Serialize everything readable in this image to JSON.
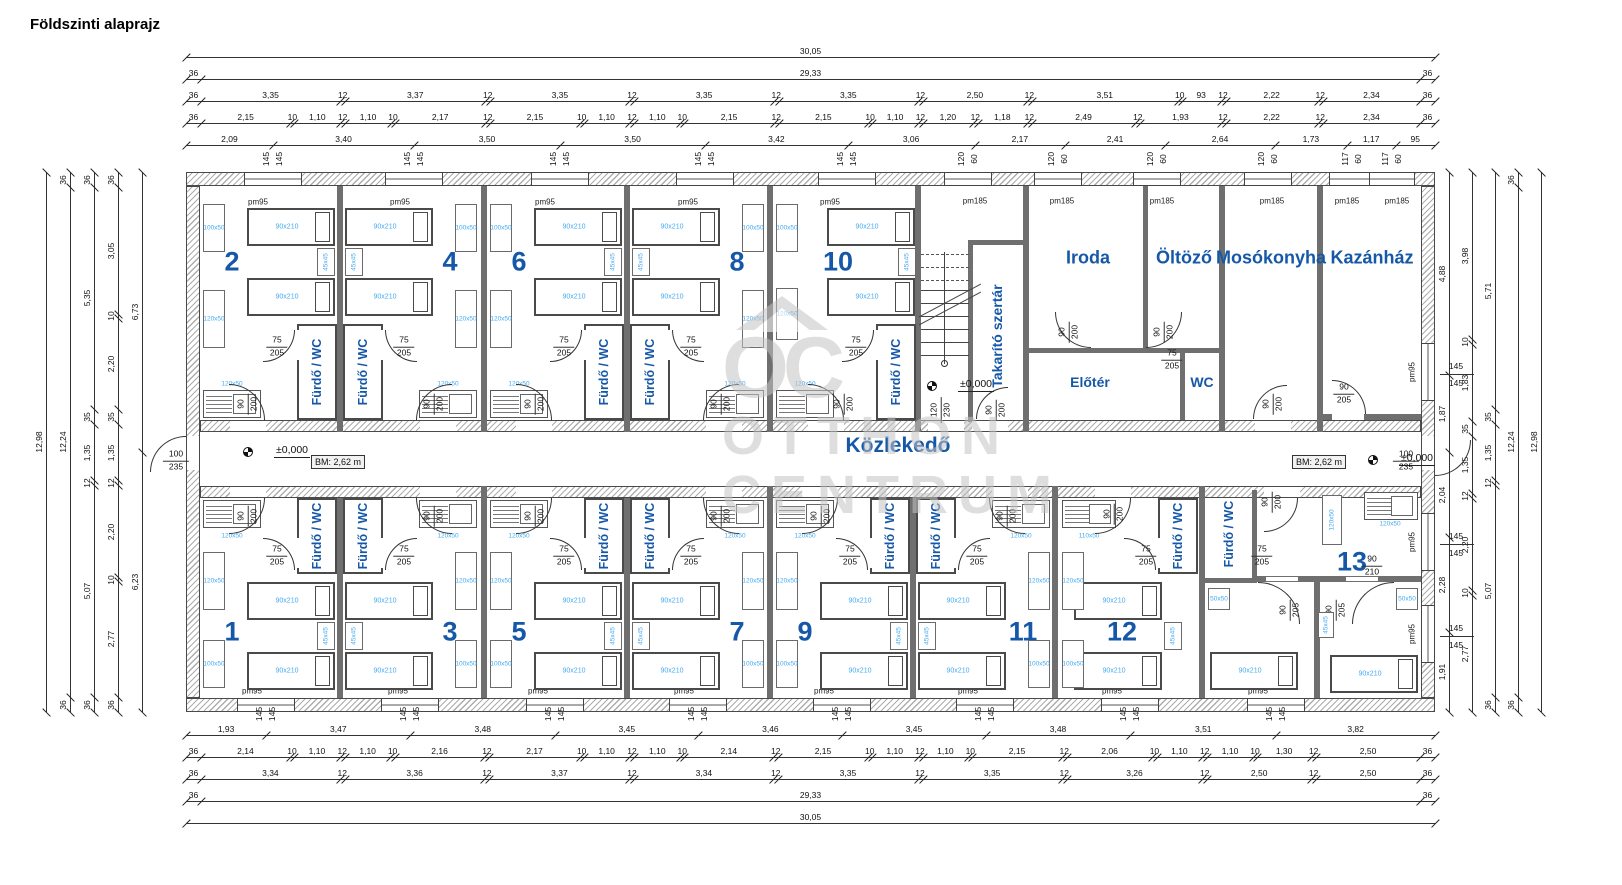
{
  "title": "Földszinti alaprajz",
  "watermark": {
    "line1": "OTTHON",
    "line2": "CENTRUM",
    "logo": "OC"
  },
  "colors": {
    "accent_blue": "#1658a8",
    "light_blue": "#45aaf0",
    "wall_gray": "#adadad",
    "watermark_gray": "#c4c4c4"
  },
  "corridor": {
    "label": "Közlekedő",
    "bm": "BM: 2,62 m",
    "level": "±0,000",
    "end_door": "100/235"
  },
  "rooms": {
    "top_pairs": [
      [
        "2",
        "4"
      ],
      [
        "6",
        "8"
      ]
    ],
    "top_single": "10",
    "bottom_pairs": [
      [
        "1",
        "3"
      ],
      [
        "5",
        "7"
      ],
      [
        "9",
        "11"
      ]
    ],
    "bottom_single": "12",
    "unit13": "13",
    "bath": "Fürdő / WC",
    "cleaning": "Takarító szertár",
    "office": "Iroda",
    "dressing": "Öltöző",
    "laundry": "Mosókonyha",
    "boiler": "Kazánház",
    "foyer": "Előtér",
    "wc": "WC"
  },
  "tags": {
    "bed": "90x210",
    "night": "45x45",
    "f100": "100x50",
    "f120": "120x50",
    "f110": "110x50",
    "f50": "50x50",
    "win_s": "pm95",
    "win_l": "pm185"
  },
  "door_dims": {
    "bath": "75/205",
    "room": "90/200",
    "stair": "120/230",
    "boiler": "90/205",
    "hall13": "90/210",
    "bed13": "90/205",
    "wc": "75/205",
    "end": "100/235"
  },
  "win_tags": {
    "top145": [
      273,
      414,
      560,
      705,
      847
    ],
    "top120_60": [
      968,
      1058,
      1157,
      1268
    ],
    "top117_60": [
      1352,
      1392
    ],
    "bottom145": [
      266,
      410,
      555,
      698,
      842,
      985,
      1130,
      1276
    ],
    "right145_y": [
      374,
      544,
      636
    ],
    "v145": [
      "145",
      "145"
    ],
    "v120": [
      "120",
      "60"
    ],
    "v117": [
      "117",
      "60"
    ]
  },
  "pm_positions": {
    "top_pm95_x": [
      258,
      400,
      545,
      688,
      830
    ],
    "top_pm185_x": [
      975,
      1062,
      1162,
      1272,
      1347,
      1397
    ],
    "bottom_pm95_x": [
      252,
      398,
      538,
      684,
      824,
      968,
      1112,
      1258
    ],
    "right_pm95_y": [
      372,
      542,
      634
    ]
  },
  "dims": {
    "top": [
      {
        "y": 57,
        "vals": [
          "30,05"
        ]
      },
      {
        "y": 79,
        "vals": [
          "36",
          "29,33",
          "36"
        ]
      },
      {
        "y": 101,
        "vals": [
          "36",
          "3,35",
          "12",
          "3,37",
          "12",
          "3,35",
          "12",
          "3,35",
          "12",
          "3,35",
          "12",
          "2,50",
          "12",
          "3,51",
          "10",
          "93",
          "12",
          "2,22",
          "12",
          "2,34",
          "36"
        ]
      },
      {
        "y": 123,
        "vals": [
          "36",
          "2,15",
          "10",
          "1,10",
          "12",
          "1,10",
          "10",
          "2,17",
          "12",
          "2,15",
          "10",
          "1,10",
          "12",
          "1,10",
          "10",
          "2,15",
          "12",
          "2,15",
          "10",
          "1,10",
          "12",
          "1,20",
          "12",
          "1,18",
          "12",
          "2,49",
          "12",
          "1,93",
          "12",
          "2,22",
          "12",
          "2,34",
          "36"
        ]
      },
      {
        "y": 145,
        "vals": [
          "2,09",
          "3,40",
          "3,50",
          "3,50",
          "3,42",
          "3,06",
          "2,17",
          "2,41",
          "2,64",
          "1,73",
          "1,17",
          "95"
        ]
      }
    ],
    "bottom": [
      {
        "y": 735,
        "vals": [
          "1,93",
          "3,47",
          "3,48",
          "3,45",
          "3,46",
          "3,45",
          "3,48",
          "3,51",
          "3,82"
        ]
      },
      {
        "y": 757,
        "vals": [
          "36",
          "2,14",
          "10",
          "1,10",
          "12",
          "1,10",
          "10",
          "2,16",
          "12",
          "2,17",
          "10",
          "1,10",
          "12",
          "1,10",
          "10",
          "2,14",
          "12",
          "2,15",
          "10",
          "1,10",
          "12",
          "1,10",
          "10",
          "2,15",
          "12",
          "2,06",
          "10",
          "1,10",
          "12",
          "1,10",
          "10",
          "1,30",
          "12",
          "2,50",
          "36"
        ]
      },
      {
        "y": 779,
        "vals": [
          "36",
          "3,34",
          "12",
          "3,36",
          "12",
          "3,37",
          "12",
          "3,34",
          "12",
          "3,35",
          "12",
          "3,35",
          "12",
          "3,26",
          "12",
          "2,50",
          "12",
          "2,50",
          "36"
        ]
      },
      {
        "y": 801,
        "vals": [
          "36",
          "29,33",
          "36"
        ]
      },
      {
        "y": 823,
        "vals": [
          "30,05"
        ]
      }
    ],
    "left": [
      {
        "x": 46,
        "vals": [
          "12,98"
        ]
      },
      {
        "x": 70,
        "vals": [
          "36",
          "12,24",
          "36"
        ]
      },
      {
        "x": 94,
        "vals": [
          "36",
          "5,35",
          "35",
          "1,35",
          "12",
          "5,07",
          "36"
        ]
      },
      {
        "x": 118,
        "vals": [
          "36",
          "3,05",
          "10",
          "2,20",
          "35",
          "1,35",
          "12",
          "2,20",
          "10",
          "2,77",
          "36"
        ]
      },
      {
        "x": 142,
        "vals": [
          "6,73",
          "6,23"
        ]
      }
    ],
    "right": [
      {
        "x": 1449,
        "vals": [
          "4,88",
          "1,87",
          "2,04",
          "2,28",
          "1,91"
        ]
      },
      {
        "x": 1472,
        "vals": [
          "3,98",
          "10",
          "1,83",
          "35",
          "1,35",
          "12",
          "2,20",
          "10",
          "2,77"
        ]
      },
      {
        "x": 1495,
        "vals": [
          "5,71",
          "35",
          "1,35",
          "12",
          "5,07",
          "36"
        ]
      },
      {
        "x": 1518,
        "vals": [
          "36",
          "12,24",
          "36"
        ]
      },
      {
        "x": 1541,
        "vals": [
          "12,98"
        ]
      }
    ]
  }
}
